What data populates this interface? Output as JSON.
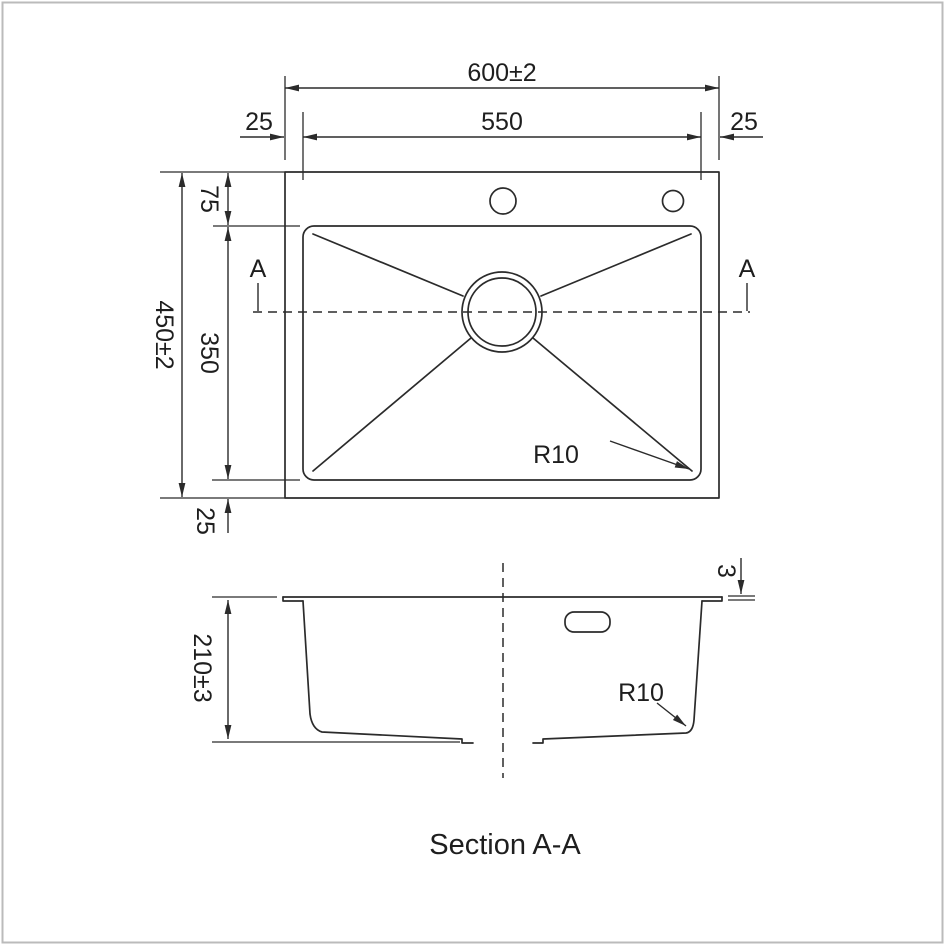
{
  "colors": {
    "line": "#2b2b2b",
    "background": "#ffffff",
    "frame": "#bbbbbb"
  },
  "top_view": {
    "dim_overall_width": "600±2",
    "dim_inner_width": "550",
    "dim_margin_left": "25",
    "dim_margin_right": "25",
    "dim_margin_top": "75",
    "dim_overall_height": "450±2",
    "dim_inner_height": "350",
    "dim_margin_bottom": "25",
    "section_label_left": "A",
    "section_label_right": "A",
    "radius_label": "R10"
  },
  "section_view": {
    "dim_depth": "210±3",
    "dim_rim_thickness": "3",
    "radius_label": "R10",
    "caption": "Section A-A"
  }
}
